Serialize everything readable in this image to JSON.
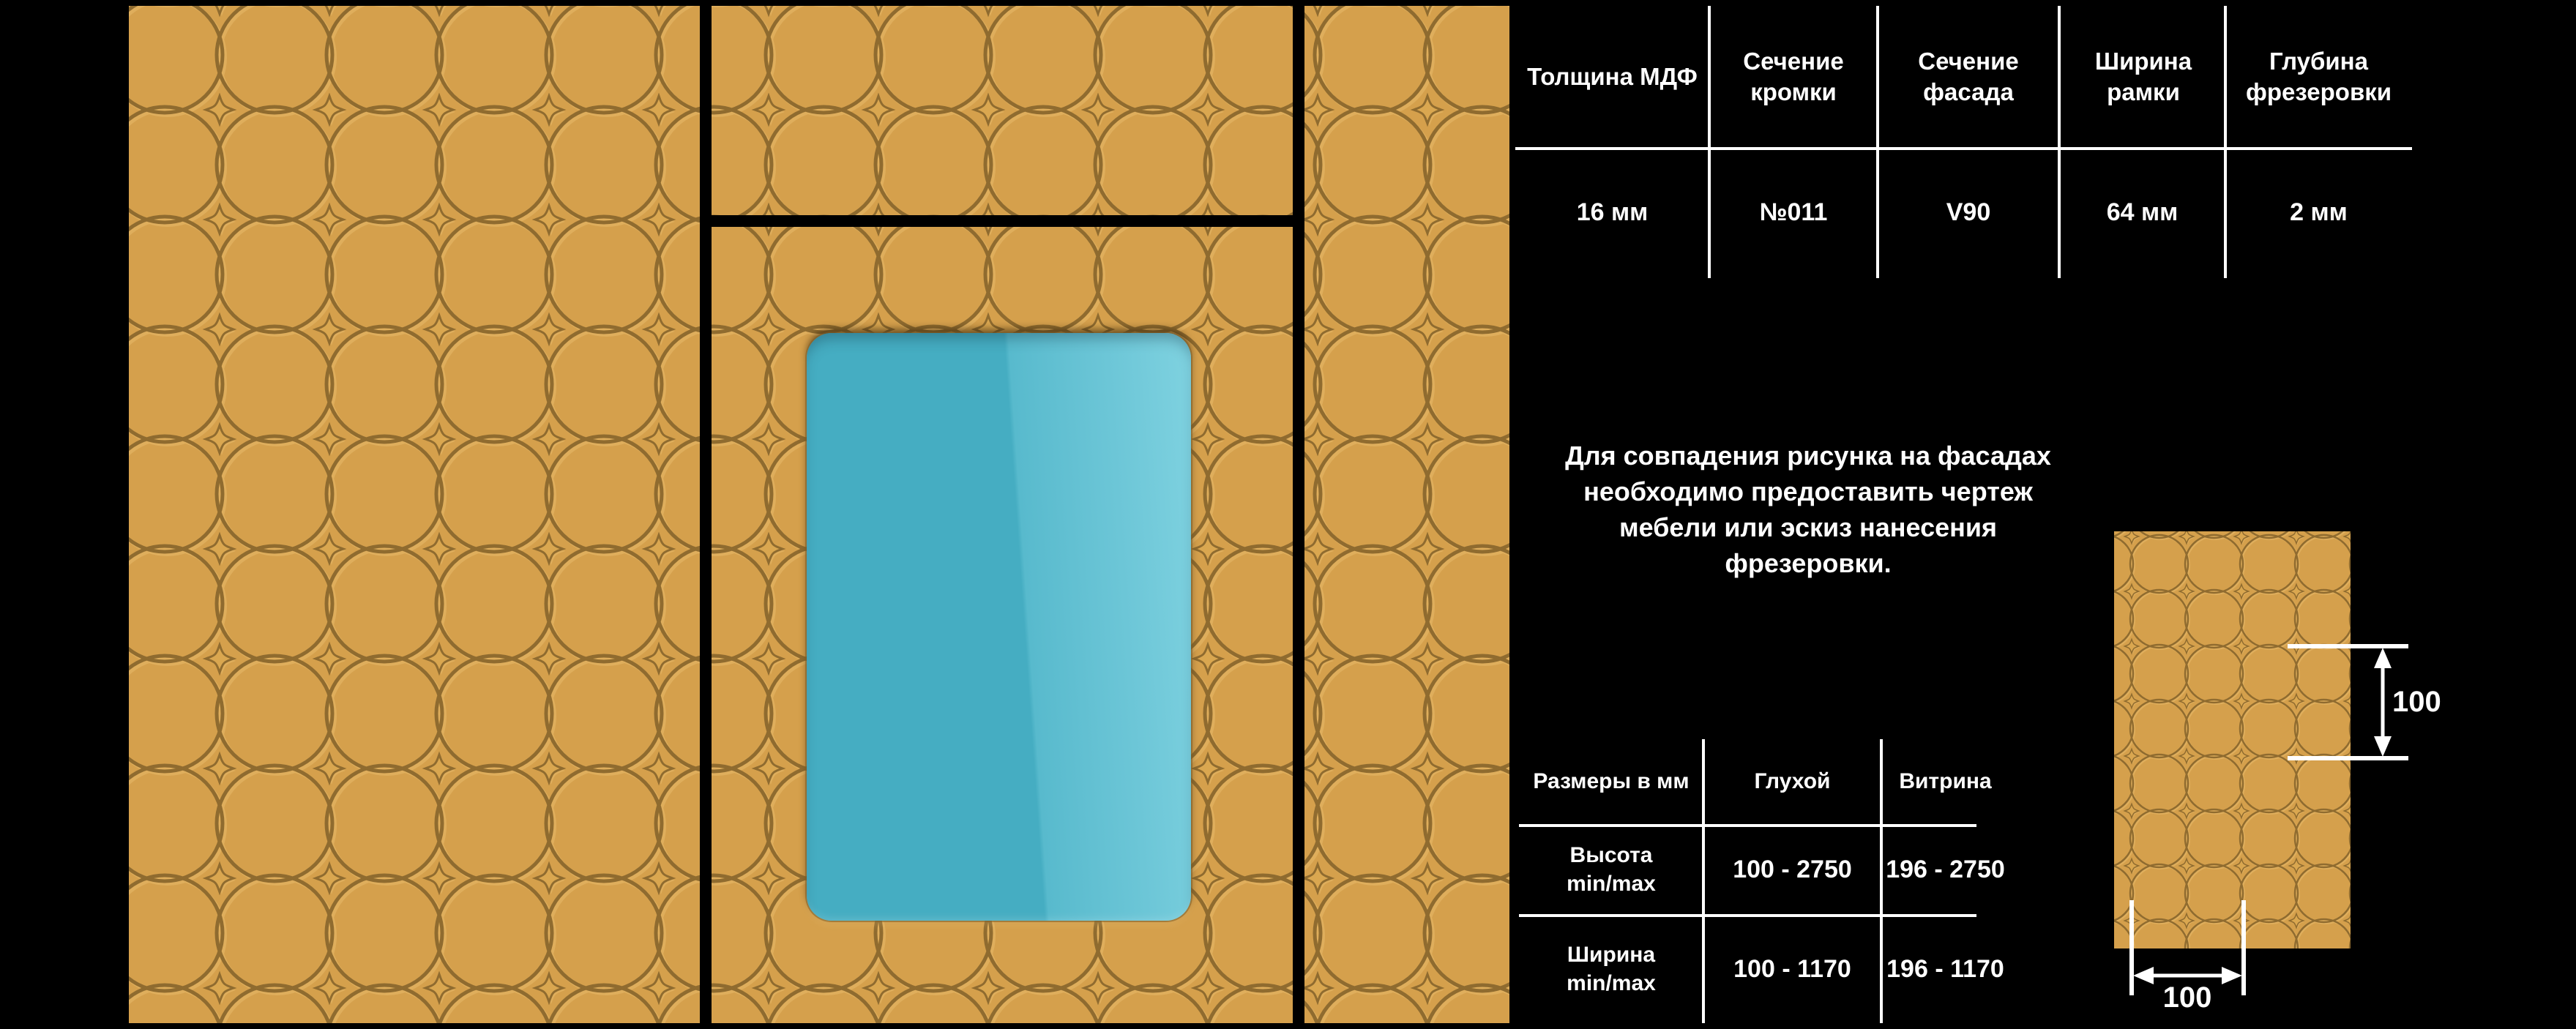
{
  "spec_table": {
    "columns": [
      {
        "header": "Толщина МДФ",
        "value": "16 мм"
      },
      {
        "header": "Сечение кромки",
        "value": "№011"
      },
      {
        "header": "Сечение фасада",
        "value": "V90"
      },
      {
        "header": "Ширина рамки",
        "value": "64 мм"
      },
      {
        "header": "Глубина фрезеровки",
        "value": "2 мм"
      }
    ]
  },
  "note_lines": [
    "Для совпадения рисунка на фасадах",
    "необходимо предоставить чертеж",
    "мебели или эскиз нанесения",
    "фрезеровки."
  ],
  "size_table": {
    "headers": [
      "Размеры в мм",
      "Глухой",
      "Витрина"
    ],
    "rows": [
      {
        "param_line1": "Высота",
        "param_line2": "min/max",
        "glukhoy": "100 - 2750",
        "vitrina": "196 - 2750"
      },
      {
        "param_line1": "Ширина",
        "param_line2": "min/max",
        "glukhoy": "100 - 1170",
        "vitrina": "196 - 1170"
      }
    ]
  },
  "sample_dimensions": {
    "vertical": "100",
    "horizontal": "100"
  },
  "colors": {
    "background": "#000000",
    "text": "#FFFFFF",
    "panel_base": "#D5A04C",
    "pattern_line_dark": "#8F6B2F",
    "pattern_line_light": "#E9BC6C",
    "glass_teal": "#47AFC4",
    "glass_light": "#7FD2E0"
  }
}
